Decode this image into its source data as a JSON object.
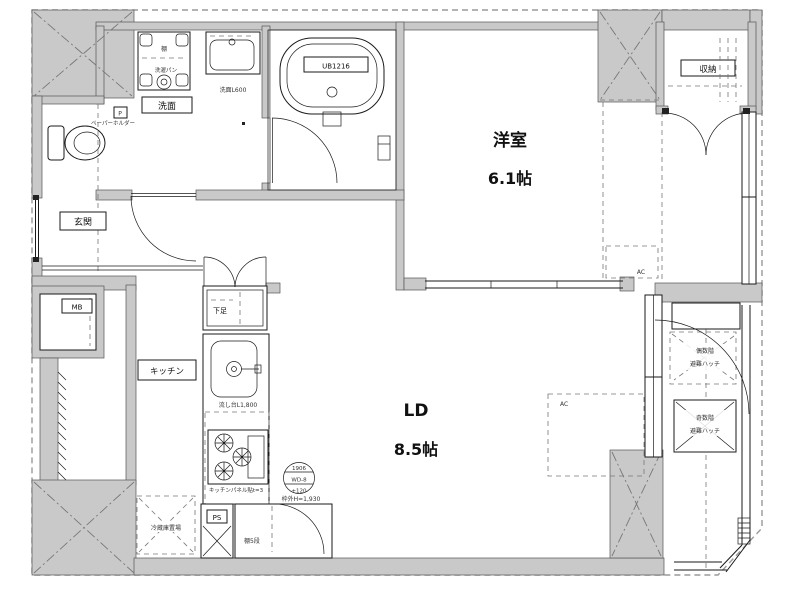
{
  "colors": {
    "wall": "#c9c9c9",
    "line": "#1a1a1a",
    "dash": "#8a8a8a",
    "bg": "#ffffff"
  },
  "rooms": {
    "western": {
      "label": "洋室",
      "size": "6.1帖"
    },
    "ld": {
      "label": "LD",
      "size": "8.5帖"
    },
    "entrance": {
      "label": "玄関"
    },
    "washroom": {
      "label": "洗面"
    },
    "storage": {
      "label": "収納"
    },
    "kitchen": {
      "label": "キッチン"
    },
    "shoe_cabinet": {
      "label": "下足"
    },
    "meter_box": {
      "label": "MB"
    },
    "pipe_space": {
      "label": "PS"
    }
  },
  "annotations": {
    "unit_bath": "UB1216",
    "vanity": "洗面L600",
    "laundry_shelf": "棚",
    "laundry_pan": "洗濯パン",
    "paper_holder_abbr": "P",
    "paper_holder": "ペーパーホルダー",
    "kitchen_sink": "流し台L1,800",
    "kitchen_panel": "キッチンパネル貼t=3",
    "fridge_space": "冷蔵庫置場",
    "shelf_5tier": "棚5段",
    "ac_west": "AC",
    "ac_ld": "AC",
    "hatch_even_line1": "偶数階",
    "hatch_even_line2": "避難ハッチ",
    "hatch_odd_line1": "奇数階",
    "hatch_odd_line2": "避難ハッチ",
    "door_code_top": "1906",
    "door_code_mid": "WD-8",
    "door_code_bottom": "+120",
    "door_frame_height": "枠外H=1,930"
  }
}
